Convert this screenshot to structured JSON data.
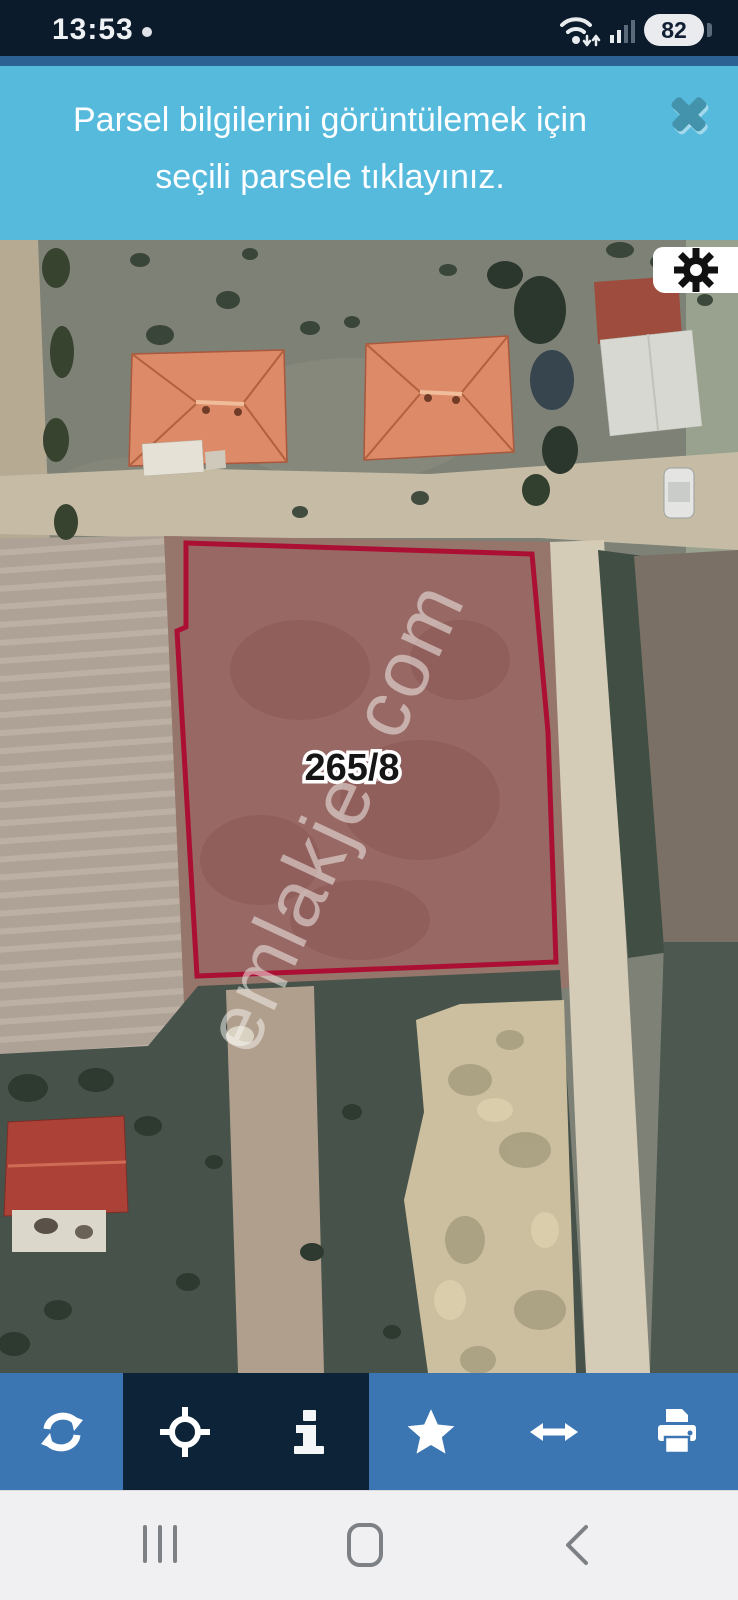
{
  "status_bar": {
    "time": "13:53",
    "notification_dot": true,
    "battery_level": "82",
    "icons": [
      "wifi-icon",
      "signal-strength-icon",
      "battery-pill"
    ]
  },
  "banner": {
    "line1": "Parsel bilgilerini görüntülemek için",
    "line2": "seçili parsele tıklayınız.",
    "close_icon": "x-icon",
    "background_color": "#56badd"
  },
  "map": {
    "type": "satellite-parcel-view",
    "parcel_label": "265/8",
    "watermark": "emlakjet.com",
    "parcel_outline_color": "#ab1034",
    "settings_icon": "gear-icon"
  },
  "toolbar": {
    "items": [
      {
        "name": "refresh",
        "icon": "refresh-icon",
        "background": "#3b76b3"
      },
      {
        "name": "locate",
        "icon": "crosshair-icon",
        "background": "#0d2438"
      },
      {
        "name": "info",
        "icon": "info-icon",
        "background": "#0d2438"
      },
      {
        "name": "favorite",
        "icon": "star-icon",
        "background": "#3b76b3"
      },
      {
        "name": "measure-width",
        "icon": "horizontal-arrow-icon",
        "background": "#3b76b3"
      },
      {
        "name": "print",
        "icon": "printer-icon",
        "background": "#3b76b3"
      }
    ]
  },
  "nav_bar": {
    "items": [
      {
        "name": "recents",
        "icon": "recents-icon"
      },
      {
        "name": "home",
        "icon": "home-icon"
      },
      {
        "name": "back",
        "icon": "back-icon"
      }
    ],
    "background_color": "#f0f0f2"
  },
  "colors": {
    "status_bar_bg": "#0c1b2c",
    "banner_bg": "#56badd",
    "parcel_outline": "#ab1034",
    "toolbar_blue": "#3b76b3",
    "toolbar_dark": "#0d2438",
    "nav_bg": "#f0f0f2"
  }
}
